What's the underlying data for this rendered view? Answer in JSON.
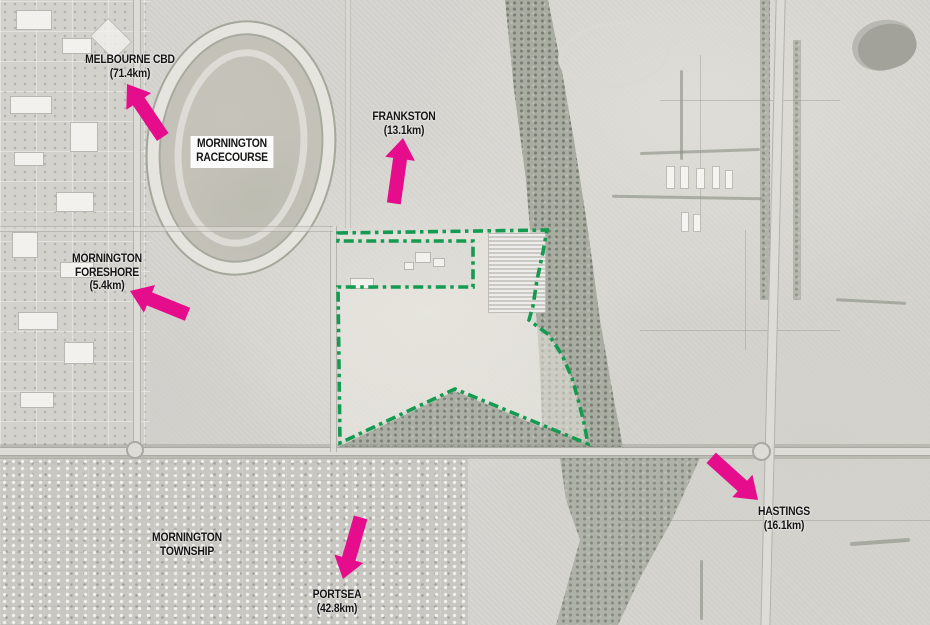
{
  "colors": {
    "arrow": "#E50D8C",
    "boundary": "#149B51",
    "label_text": "#141414"
  },
  "labels": {
    "melbourne_cbd": {
      "name": "MELBOURNE CBD",
      "distance": "(71.4km)"
    },
    "frankston": {
      "name": "FRANKSTON",
      "distance": "(13.1km)"
    },
    "racecourse": {
      "line1": "MORNINGTON",
      "line2": "RACECOURSE"
    },
    "foreshore": {
      "line1": "MORNINGTON",
      "line2": "FORESHORE",
      "distance": "(5.4km)"
    },
    "hastings": {
      "name": "HASTINGS",
      "distance": "(16.1km)"
    },
    "township": {
      "line1": "MORNINGTON",
      "line2": "TOWNSHIP"
    },
    "portsea": {
      "name": "PORTSEA",
      "distance": "(42.8km)"
    }
  }
}
